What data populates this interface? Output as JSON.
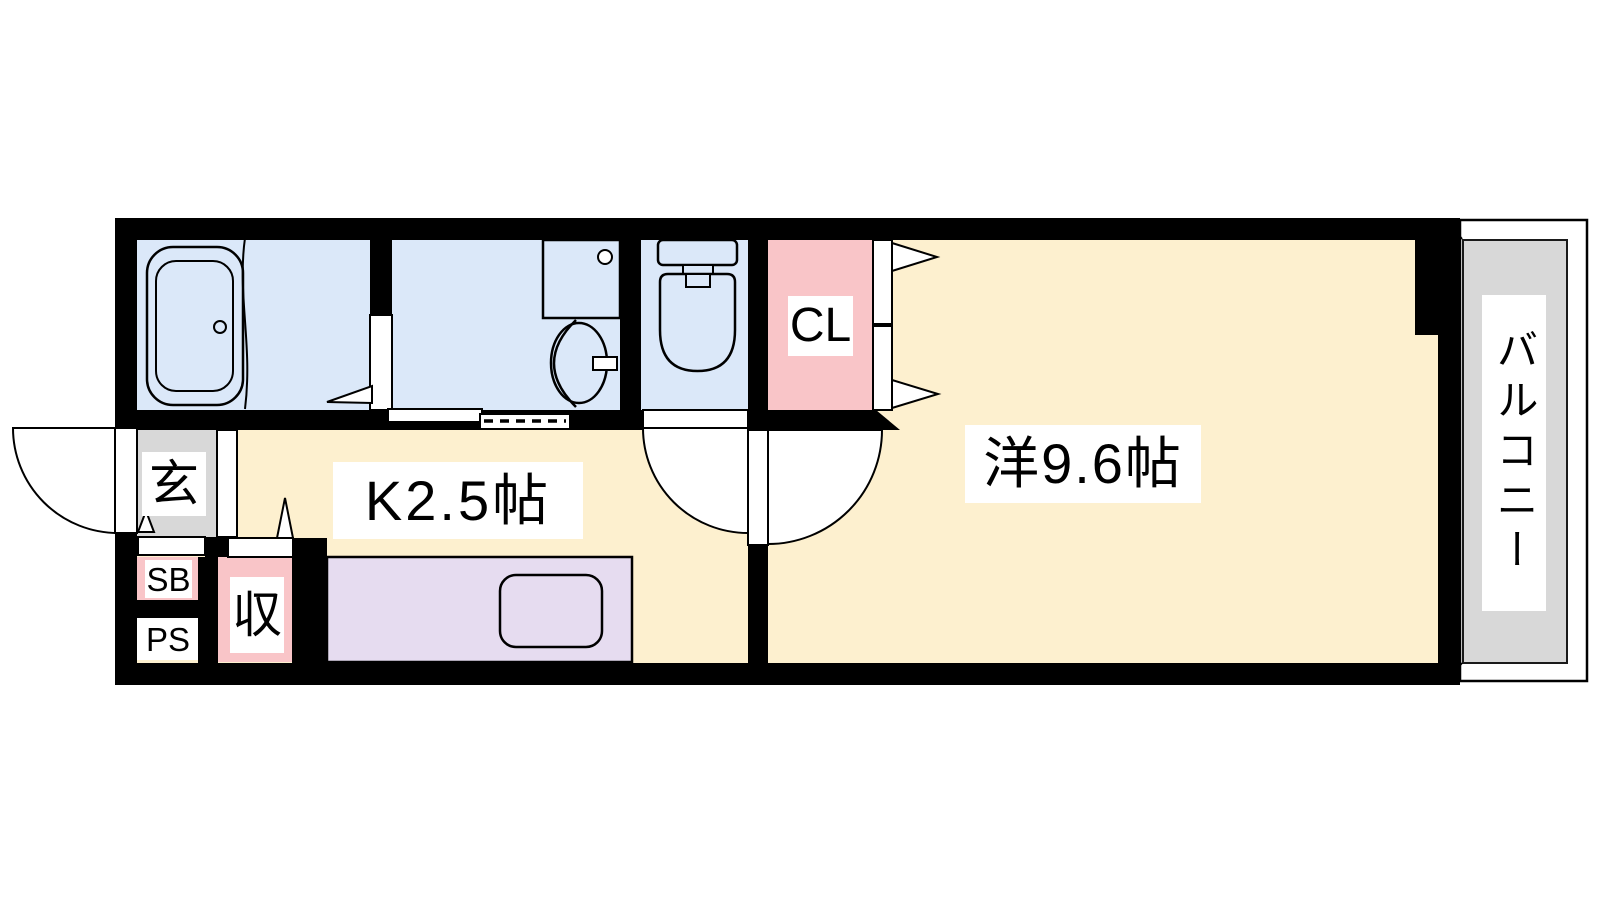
{
  "colors": {
    "wall": "#000000",
    "wet-blue": "#dbe8f9",
    "floor-cream": "#fdf0cf",
    "closet-pink": "#f9c5c8",
    "entrance-gray": "#d8d8d8",
    "counter-purple": "#e6dcf0",
    "label-bg": "#ffffff",
    "line": "#000000"
  },
  "rooms": {
    "entrance": {
      "label": "玄"
    },
    "shoebox": {
      "label": "SB"
    },
    "pipe_space": {
      "label": "PS"
    },
    "storage": {
      "label": "収"
    },
    "kitchen": {
      "label": "K2.5帖"
    },
    "closet": {
      "label": "CL"
    },
    "western_room": {
      "label": "洋9.6帖"
    },
    "balcony": {
      "label": "バルコニー"
    }
  }
}
